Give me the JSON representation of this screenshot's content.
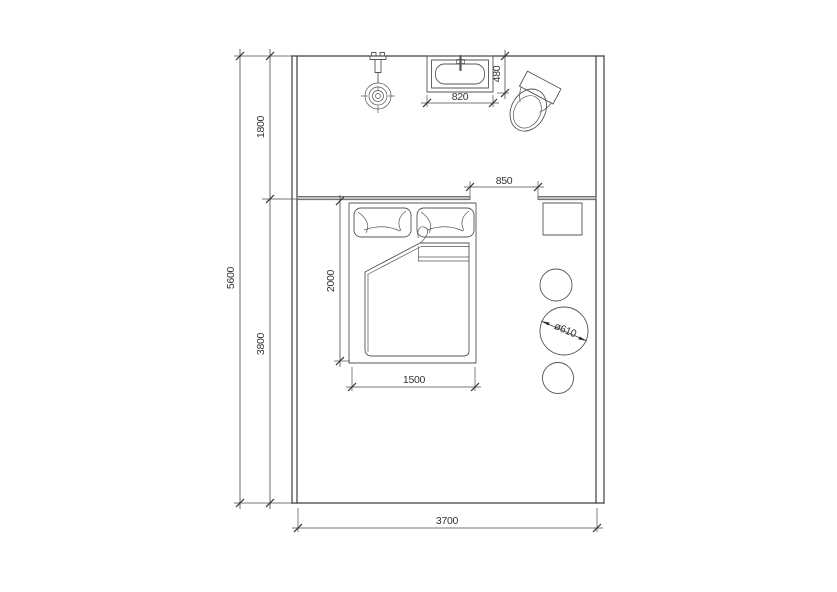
{
  "page": {
    "background": "#ffffff",
    "line_color": "#4a4a4a",
    "wall_color": "#3e3e3e",
    "text_color": "#333333"
  },
  "plan": {
    "type": "floor-plan",
    "room": {
      "width_mm": 3700,
      "depth_mm": 5600
    },
    "zones": [
      {
        "name": "bathroom",
        "depth_label": "1800"
      },
      {
        "name": "bedroom",
        "depth_label": "3800"
      }
    ],
    "dimensions": {
      "total_depth": "5600",
      "upper_zone": "1800",
      "lower_zone": "3800",
      "room_width": "3700",
      "opening": "850",
      "basin_width": "820",
      "basin_depth": "480",
      "bed_length": "2000",
      "bed_width": "1500",
      "table_diameter": "ø610"
    },
    "fixtures": [
      {
        "name": "shower-head"
      },
      {
        "name": "wash-basin",
        "size": "820 × 480"
      },
      {
        "name": "toilet"
      },
      {
        "name": "double-bed",
        "size": "1500 × 2000"
      },
      {
        "name": "side-table"
      },
      {
        "name": "round-table",
        "size": "ø610"
      },
      {
        "name": "stool-upper"
      },
      {
        "name": "stool-lower"
      }
    ]
  }
}
